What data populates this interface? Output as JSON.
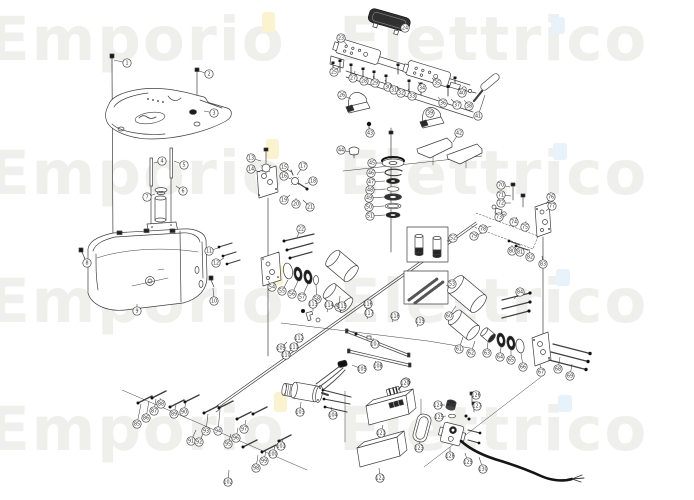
{
  "watermark": {
    "color": "#efefec",
    "font_size": 61,
    "letter_spacing": 2,
    "word_spacing": 30,
    "rows": [
      {
        "text": "Emporio Elettrico",
        "x": -12,
        "y": 60
      },
      {
        "text": "Emporio Elettrico",
        "x": -12,
        "y": 194
      },
      {
        "text": "Emporio Elettrico",
        "x": -12,
        "y": 322
      },
      {
        "text": "Emporio Elettrico",
        "x": -12,
        "y": 450
      }
    ]
  },
  "accents": [
    {
      "name": "i-dot-yellow",
      "color": "#fbf3cf",
      "rects": [
        [
          262,
          12,
          13,
          20
        ],
        [
          266,
          139,
          13,
          20
        ],
        [
          270,
          265,
          13,
          20
        ],
        [
          274,
          392,
          13,
          20
        ]
      ]
    },
    {
      "name": "i-dot-blue",
      "color": "#e7f2fa",
      "rects": [
        [
          551,
          17,
          14,
          17
        ],
        [
          553,
          143,
          14,
          17
        ],
        [
          556,
          269,
          14,
          17
        ],
        [
          558,
          395,
          14,
          17
        ]
      ]
    }
  ],
  "diagram": {
    "stroke": "#3f3f3f",
    "callout_radius": 4.2,
    "callout_font_size": 4.8,
    "callouts": [
      [
        1,
        127,
        63,
        114,
        60
      ],
      [
        2,
        209,
        74,
        199,
        71
      ],
      [
        3,
        214,
        113,
        204,
        111
      ],
      [
        4,
        162,
        161,
        154,
        163
      ],
      [
        5,
        184,
        165,
        174,
        161
      ],
      [
        6,
        183,
        191,
        176,
        186
      ],
      [
        7,
        147,
        197,
        155,
        194
      ],
      [
        8,
        87,
        263,
        84,
        257
      ],
      [
        9,
        137,
        311,
        137,
        304
      ],
      [
        10,
        214,
        301,
        213,
        288
      ],
      [
        11,
        209,
        251,
        218,
        248
      ],
      [
        12,
        216,
        263,
        224,
        258
      ],
      [
        13,
        251,
        158,
        261,
        161
      ],
      [
        14,
        251,
        169,
        260,
        172
      ],
      [
        15,
        284,
        167,
        291,
        172
      ],
      [
        16,
        284,
        176,
        291,
        179
      ],
      [
        17,
        303,
        166,
        297,
        175
      ],
      [
        18,
        313,
        181,
        305,
        184
      ],
      [
        19,
        284,
        200,
        290,
        195
      ],
      [
        20,
        296,
        204,
        296,
        198
      ],
      [
        21,
        310,
        207,
        303,
        200
      ],
      [
        22,
        301,
        229,
        297,
        237
      ],
      [
        23,
        341,
        38,
        347,
        45
      ],
      [
        24,
        405,
        28,
        396,
        24
      ],
      [
        25,
        334,
        72,
        340,
        66
      ],
      [
        26,
        342,
        95,
        351,
        99
      ],
      [
        27,
        353,
        78,
        355,
        71
      ],
      [
        28,
        364,
        81,
        363,
        74
      ],
      [
        29,
        375,
        83,
        373,
        76
      ],
      [
        30,
        388,
        87,
        385,
        80
      ],
      [
        31,
        394,
        90,
        390,
        83
      ],
      [
        32,
        401,
        93,
        397,
        86
      ],
      [
        33,
        412,
        96,
        408,
        89
      ],
      [
        34,
        422,
        88,
        418,
        82
      ],
      [
        35,
        437,
        83,
        432,
        78
      ],
      [
        36,
        443,
        103,
        438,
        97
      ],
      [
        37,
        457,
        105,
        451,
        99
      ],
      [
        38,
        469,
        106,
        464,
        100
      ],
      [
        39,
        430,
        113,
        431,
        118
      ],
      [
        40,
        462,
        93,
        458,
        88
      ],
      [
        41,
        478,
        116,
        485,
        95
      ],
      [
        42,
        459,
        133,
        453,
        142
      ],
      [
        43,
        370,
        133,
        369,
        127
      ],
      [
        44,
        341,
        150,
        350,
        152
      ],
      [
        45,
        372,
        163,
        383,
        163
      ],
      [
        46,
        371,
        173,
        384,
        172
      ],
      [
        47,
        371,
        182,
        385,
        181
      ],
      [
        48,
        370,
        190,
        386,
        189
      ],
      [
        49,
        369,
        198,
        385,
        197
      ],
      [
        50,
        369,
        207,
        384,
        206
      ],
      [
        51,
        370,
        216,
        385,
        215
      ],
      [
        52,
        453,
        238,
        447,
        241
      ],
      [
        53,
        452,
        284,
        446,
        286
      ],
      [
        54,
        272,
        287,
        268,
        281
      ],
      [
        55,
        282,
        291,
        288,
        280
      ],
      [
        56,
        292,
        294,
        298,
        281
      ],
      [
        57,
        302,
        297,
        308,
        284
      ],
      [
        58,
        317,
        299,
        316,
        285
      ],
      [
        59,
        339,
        307,
        340,
        296
      ],
      [
        60,
        449,
        316,
        456,
        306
      ],
      [
        61,
        459,
        349,
        463,
        337
      ],
      [
        62,
        471,
        353,
        475,
        341
      ],
      [
        63,
        487,
        353,
        488,
        342
      ],
      [
        64,
        500,
        357,
        501,
        347
      ],
      [
        65,
        511,
        360,
        511,
        349
      ],
      [
        66,
        523,
        367,
        521,
        353
      ],
      [
        67,
        541,
        372,
        540,
        364
      ],
      [
        68,
        558,
        369,
        560,
        357
      ],
      [
        69,
        570,
        376,
        572,
        364
      ],
      [
        70,
        501,
        185,
        510,
        187
      ],
      [
        71,
        501,
        195,
        511,
        196
      ],
      [
        72,
        501,
        203,
        511,
        203
      ],
      [
        73,
        499,
        217,
        505,
        214
      ],
      [
        74,
        514,
        222,
        517,
        217
      ],
      [
        75,
        525,
        227,
        526,
        221
      ],
      [
        76,
        551,
        197,
        546,
        204
      ],
      [
        77,
        552,
        206,
        546,
        211
      ],
      [
        78,
        483,
        229,
        491,
        226
      ],
      [
        79,
        474,
        236,
        482,
        233
      ],
      [
        80,
        512,
        251,
        512,
        245
      ],
      [
        81,
        520,
        252,
        521,
        247
      ],
      [
        82,
        530,
        257,
        529,
        249
      ],
      [
        83,
        543,
        264,
        542,
        256
      ],
      [
        84,
        520,
        292,
        514,
        299
      ],
      [
        85,
        137,
        424,
        141,
        404
      ],
      [
        86,
        146,
        418,
        149,
        401
      ],
      [
        87,
        154,
        411,
        156,
        399
      ],
      [
        88,
        161,
        404,
        160,
        398
      ],
      [
        89,
        174,
        414,
        176,
        405
      ],
      [
        90,
        184,
        412,
        186,
        401
      ],
      [
        91,
        191,
        441,
        196,
        430
      ],
      [
        92,
        199,
        442,
        204,
        432
      ],
      [
        93,
        206,
        431,
        208,
        414
      ],
      [
        94,
        218,
        431,
        220,
        410
      ],
      [
        95,
        228,
        444,
        231,
        434
      ],
      [
        96,
        236,
        438,
        238,
        428
      ],
      [
        97,
        244,
        429,
        246,
        420
      ],
      [
        98,
        256,
        468,
        258,
        455
      ],
      [
        99,
        264,
        461,
        266,
        450
      ],
      [
        100,
        273,
        454,
        275,
        446
      ],
      [
        101,
        281,
        446,
        283,
        440
      ],
      [
        102,
        228,
        482,
        229,
        470
      ],
      [
        103,
        300,
        412,
        301,
        402
      ],
      [
        104,
        333,
        415,
        331,
        407
      ],
      [
        105,
        362,
        369,
        352,
        365
      ],
      [
        106,
        406,
        382,
        398,
        389
      ],
      [
        107,
        375,
        344,
        373,
        338
      ],
      [
        108,
        378,
        366,
        375,
        361
      ],
      [
        109,
        281,
        348,
        287,
        342
      ],
      [
        110,
        286,
        355,
        292,
        349
      ],
      [
        111,
        294,
        347,
        299,
        341
      ],
      [
        112,
        299,
        338,
        303,
        333
      ],
      [
        113,
        313,
        304,
        313,
        311
      ],
      [
        114,
        329,
        305,
        327,
        312
      ],
      [
        115,
        342,
        306,
        340,
        313
      ],
      [
        116,
        368,
        304,
        366,
        311
      ],
      [
        117,
        369,
        313,
        367,
        319
      ],
      [
        118,
        395,
        316,
        392,
        322
      ],
      [
        119,
        420,
        321,
        417,
        327
      ],
      [
        120,
        405,
        383,
        398,
        390
      ],
      [
        121,
        381,
        433,
        383,
        425
      ],
      [
        122,
        380,
        478,
        379,
        468
      ],
      [
        123,
        419,
        448,
        420,
        441
      ],
      [
        124,
        438,
        405,
        445,
        405
      ],
      [
        125,
        439,
        417,
        446,
        416
      ],
      [
        126,
        476,
        395,
        472,
        397
      ],
      [
        127,
        477,
        406,
        473,
        407
      ],
      [
        128,
        450,
        456,
        450,
        447
      ],
      [
        129,
        468,
        462,
        465,
        453
      ],
      [
        130,
        483,
        469,
        479,
        457
      ]
    ]
  }
}
